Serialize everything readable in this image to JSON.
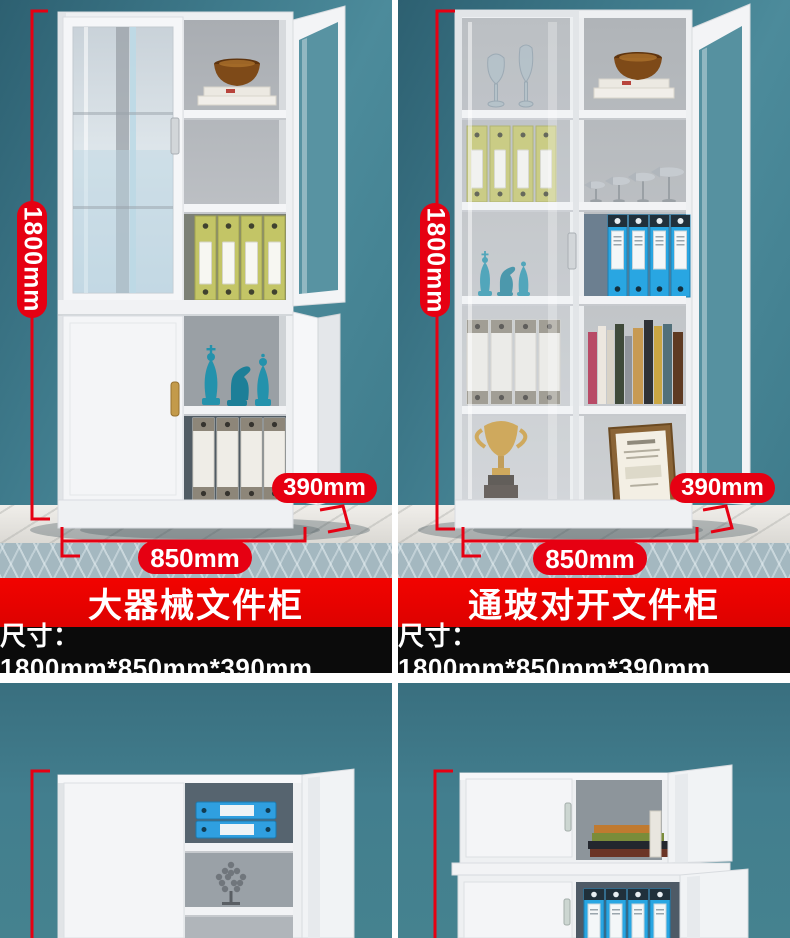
{
  "colors": {
    "accent_red": "#e60012",
    "banner_red": "#f20300",
    "bar_black": "#0b0b0b",
    "divider_white": "#ffffff",
    "wall_teal": "#417f90",
    "wall_teal_dark": "#2d6071",
    "wall_teal_light": "#4c8b9b",
    "cabinet_white": "#eff1f3",
    "binder_yellow": "#c3c566",
    "binder_blue": "#29a6e2",
    "chess_glass_teal": "#2492ac",
    "trophy_gold": "#c8952f",
    "marble_floor": "#e6e4df",
    "carpet_blue_gray": "#a4b8c0"
  },
  "products": [
    {
      "name": "大器械文件柜",
      "size_text": "尺寸：1800mm*850mm*390mm",
      "height_label": "1800mm",
      "width_label": "850mm",
      "depth_label": "390mm"
    },
    {
      "name": "通玻对开文件柜",
      "size_text": "尺寸：1800mm*850mm*390mm",
      "height_label": "1800mm",
      "width_label": "850mm",
      "depth_label": "390mm"
    }
  ]
}
